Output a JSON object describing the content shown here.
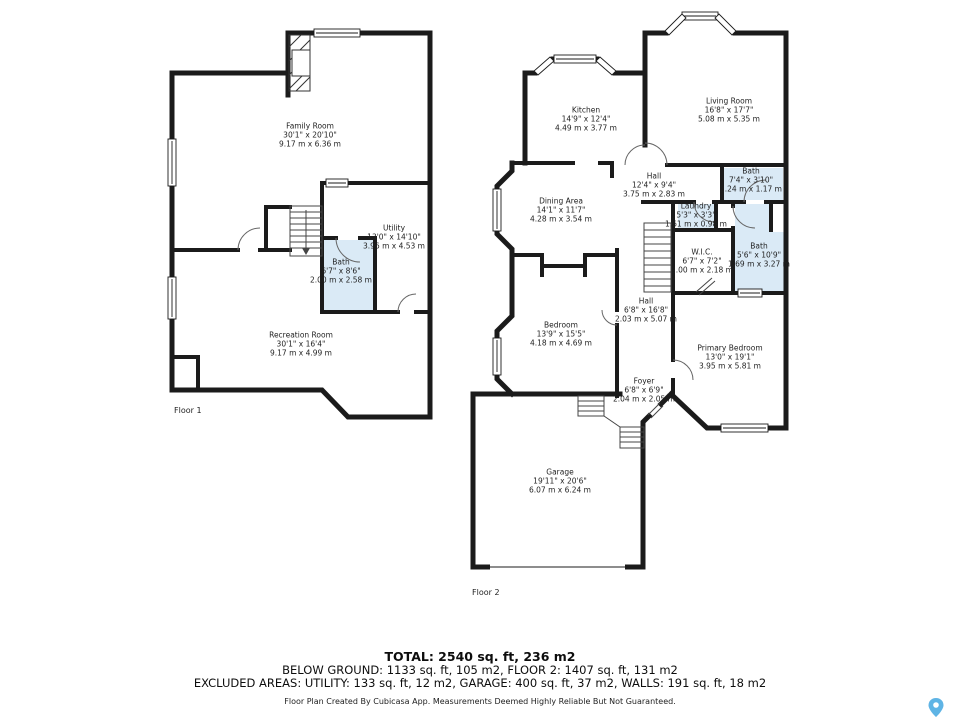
{
  "floor1": {
    "label": "Floor 1",
    "rooms": {
      "family": {
        "name": "Family Room",
        "imperial": "30'1\" x 20'10\"",
        "metric": "9.17 m x 6.36 m"
      },
      "utility": {
        "name": "Utility",
        "imperial": "13'0\" x 14'10\"",
        "metric": "3.96 m x 4.53 m"
      },
      "bath": {
        "name": "Bath",
        "imperial": "6'7\" x 8'6\"",
        "metric": "2.00 m x 2.58 m"
      },
      "recreation": {
        "name": "Recreation Room",
        "imperial": "30'1\" x 16'4\"",
        "metric": "9.17 m x 4.99 m"
      }
    }
  },
  "floor2": {
    "label": "Floor 2",
    "rooms": {
      "kitchen": {
        "name": "Kitchen",
        "imperial": "14'9\" x 12'4\"",
        "metric": "4.49 m x 3.77 m"
      },
      "living": {
        "name": "Living Room",
        "imperial": "16'8\" x 17'7\"",
        "metric": "5.08 m x 5.35 m"
      },
      "hall_upper": {
        "name": "Hall",
        "imperial": "12'4\" x 9'4\"",
        "metric": "3.75 m x 2.83 m"
      },
      "bath_upper": {
        "name": "Bath",
        "imperial": "7'4\" x 3'10\"",
        "metric": "2.24 m x 1.17 m"
      },
      "laundry": {
        "name": "Laundry",
        "imperial": "5'3\" x 3'3\"",
        "metric": "1.61 m x 0.98 m"
      },
      "dining": {
        "name": "Dining Area",
        "imperial": "14'1\" x 11'7\"",
        "metric": "4.28 m x 3.54 m"
      },
      "wic": {
        "name": "W.I.C.",
        "imperial": "6'7\" x 7'2\"",
        "metric": "2.00 m x 2.18 m"
      },
      "bath_main": {
        "name": "Bath",
        "imperial": "5'6\" x 10'9\"",
        "metric": "1.69 m x 3.27 m"
      },
      "bedroom": {
        "name": "Bedroom",
        "imperial": "13'9\" x 15'5\"",
        "metric": "4.18 m x 4.69 m"
      },
      "hall_lower": {
        "name": "Hall",
        "imperial": "6'8\" x 16'8\"",
        "metric": "2.03 m x 5.07 m"
      },
      "primary": {
        "name": "Primary Bedroom",
        "imperial": "13'0\" x 19'1\"",
        "metric": "3.95 m x 5.81 m"
      },
      "foyer": {
        "name": "Foyer",
        "imperial": "6'8\" x 6'9\"",
        "metric": "2.04 m x 2.05 m"
      },
      "garage": {
        "name": "Garage",
        "imperial": "19'11\" x 20'6\"",
        "metric": "6.07 m x 6.24 m"
      }
    }
  },
  "footer": {
    "total": "TOTAL: 2540 sq. ft, 236 m2",
    "below_ground": "BELOW GROUND: 1133 sq. ft, 105 m2, FLOOR 2: 1407 sq. ft, 131 m2",
    "excluded": "EXCLUDED AREAS: UTILITY: 133 sq. ft, 12 m2, GARAGE: 400 sq. ft, 37 m2, WALLS: 191 sq. ft, 18 m2",
    "disclaimer": "Floor Plan Created By Cubicasa App. Measurements Deemed Highly Reliable But Not Guaranteed."
  },
  "colors": {
    "wall": "#1b1b1b",
    "bath_fill": "#daeaf6",
    "pin": "#5FB4E5"
  }
}
